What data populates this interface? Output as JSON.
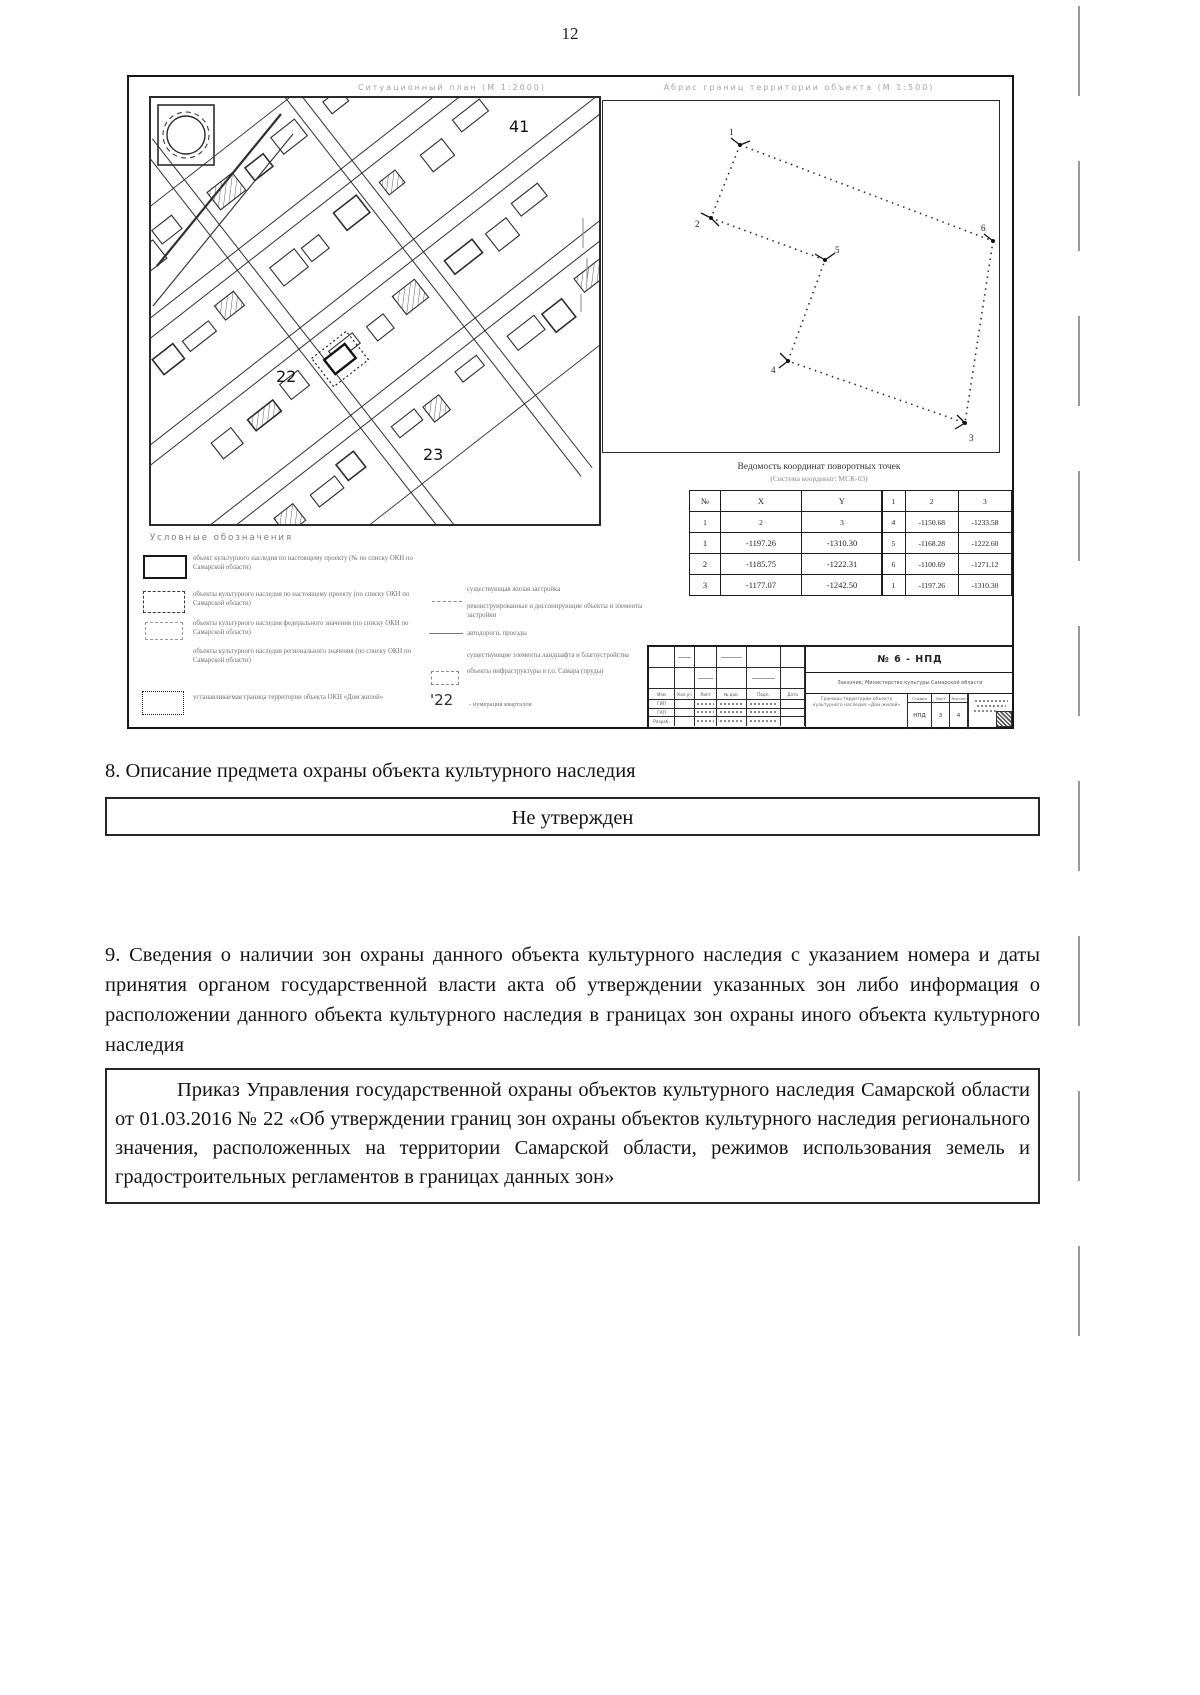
{
  "page": {
    "number": "12"
  },
  "figure": {
    "left_header": "Ситуационный план (М 1:2000)",
    "right_header": "Абрис границ территории объекта (М 1:500)",
    "map": {
      "block41": "41",
      "block22": "22",
      "block23": "23"
    },
    "boundary": {
      "points": [
        "1",
        "2",
        "3",
        "4",
        "5",
        "6"
      ]
    },
    "coords": {
      "title": "Ведомость координат поворотных точек",
      "subtitle": "(Система координат: МСК-63)",
      "left": {
        "h": [
          "№",
          "X",
          "Y"
        ],
        "s": [
          "1",
          "2",
          "3"
        ],
        "rows": [
          [
            "1",
            "-1197.26",
            "-1310.30"
          ],
          [
            "2",
            "-1185.75",
            "-1222.31"
          ],
          [
            "3",
            "-1177.07",
            "-1242.50"
          ]
        ]
      },
      "right": {
        "h": [
          "1",
          "2",
          "3"
        ],
        "rows": [
          [
            "4",
            "-1150.68",
            "-1233.58"
          ],
          [
            "5",
            "-1168.28",
            "-1222.60"
          ],
          [
            "6",
            "-1100.69",
            "-1271.12"
          ],
          [
            "1",
            "-1197.26",
            "-1310.30"
          ]
        ]
      }
    },
    "legend": {
      "title": "Условные обозначения",
      "col1": [
        "объект культурного наследия по настоящему проекту (№ по списку ОКН по Самарской области)",
        "объекты культурного наследия по настоящему проекту (по списку ОКН по Самарской области)",
        "объекты культурного наследия федерального значения (по списку ОКН по Самарской области)",
        "объекты культурного наследия регионального значения (по списку ОКН по Самарской области)",
        "устанавливаемая граница территории объекта ОКН «Дом жилой»"
      ],
      "col2": [
        "существующая жилая застройка",
        "реконструированные и диссонирующие объекты и элементы застройки",
        "автодороги, проезды",
        "существующие элементы ландшафта и благоустройства",
        "объекты инфраструктуры в г.о. Самара (пруды)"
      ],
      "quarter_num": "'22",
      "quarter_label": "- нумерация кварталов"
    },
    "stamp": {
      "number": "№ 6 - НПД",
      "customer": "Заказчик: Министерство культуры Самарской области",
      "cols": [
        "Изм",
        "Кол.уч",
        "Лист",
        "№ док.",
        "Подп.",
        "Дата"
      ],
      "roles": [
        "ГИП",
        "ГАП",
        "Разраб."
      ],
      "project": "Границы территории объекта культурного наследия «Дом жилой»",
      "stage_h": [
        "Стадия",
        "Лист",
        "Листов"
      ],
      "stage_v": [
        "НПД",
        "3",
        "4"
      ]
    }
  },
  "section8": {
    "heading": "8. Описание предмета охраны объекта культурного наследия",
    "value": "Не утвержден"
  },
  "section9": {
    "heading": "9. Сведения о наличии зон охраны данного объекта культурного наследия с указанием номера и даты принятия органом государственной власти акта об утверждении указанных зон либо информация о расположении данного объекта культурного наследия в границах зон охраны иного объекта культурного наследия",
    "value": "Приказ Управления государственной охраны объектов культурного наследия Самарской области от 01.03.2016 № 22 «Об утверждении границ зон охраны объектов культурного наследия регионального значения, расположенных на территории Самарской области, режимов использования земель и градостроительных регламентов в границах данных зон»"
  }
}
